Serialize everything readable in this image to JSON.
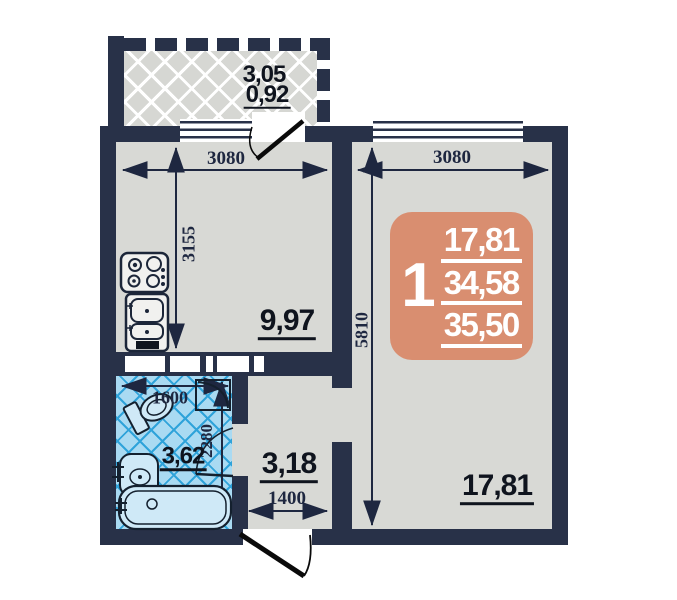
{
  "plan": {
    "colors": {
      "wall": "#283148",
      "floor": "#d8d9d5",
      "balcony_floor": "#d6d7d3",
      "bath_fill": "#a9daf2",
      "bath_grid": "#2fa3da",
      "badge": "#d98e70",
      "dim_text": "#1e2740",
      "area_text": "#0f141e"
    },
    "badge": {
      "rooms": "1",
      "living_area": "17,81",
      "usable_area": "34,58",
      "total_area": "35,50"
    },
    "balcony": {
      "area_full": "3,05",
      "area_reduced": "0,92"
    },
    "kitchen": {
      "area": "9,97",
      "dim_width": "3080",
      "dim_height": "3155"
    },
    "living_room": {
      "area": "17,81",
      "dim_width": "3080",
      "dim_height": "5810"
    },
    "bathroom": {
      "area": "3,62",
      "dim_width": "1600",
      "dim_height": "2280"
    },
    "hallway": {
      "area": "3,18",
      "dim_width": "1400"
    }
  }
}
